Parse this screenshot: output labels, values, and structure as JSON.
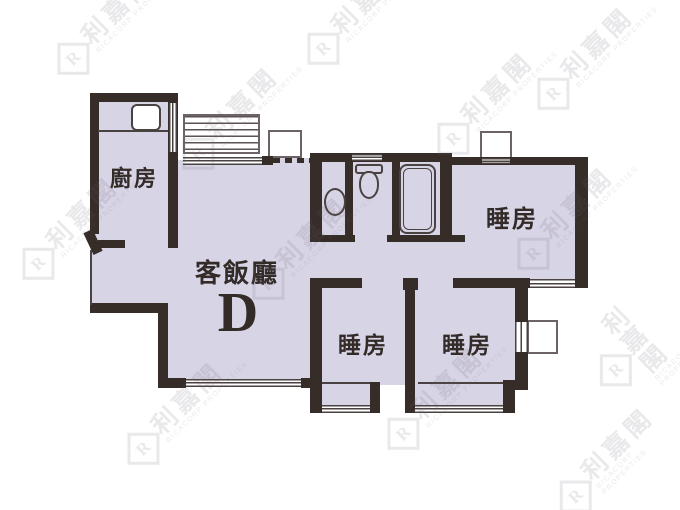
{
  "floorplan": {
    "unit_label": "D",
    "rooms": {
      "kitchen": {
        "label": "廚房"
      },
      "living_dining": {
        "label": "客飯廳"
      },
      "bedroom_top_right": {
        "label": "睡房"
      },
      "bedroom_bottom_left": {
        "label": "睡房"
      },
      "bedroom_bottom_right": {
        "label": "睡房"
      }
    },
    "fixtures": [
      "kitchen-sink",
      "washbasin",
      "toilet",
      "bathtub",
      "louver-window",
      "ac-platform",
      "window-box"
    ],
    "colors": {
      "floor": "#d7d4e6",
      "wall": "#362d28",
      "line": "#4a4240",
      "watermark": "#6b6370"
    },
    "watermark": {
      "brand_cjk": "利嘉閣",
      "brand_en": "RICACORP PROPERTIES",
      "logo_letter": "R"
    }
  }
}
